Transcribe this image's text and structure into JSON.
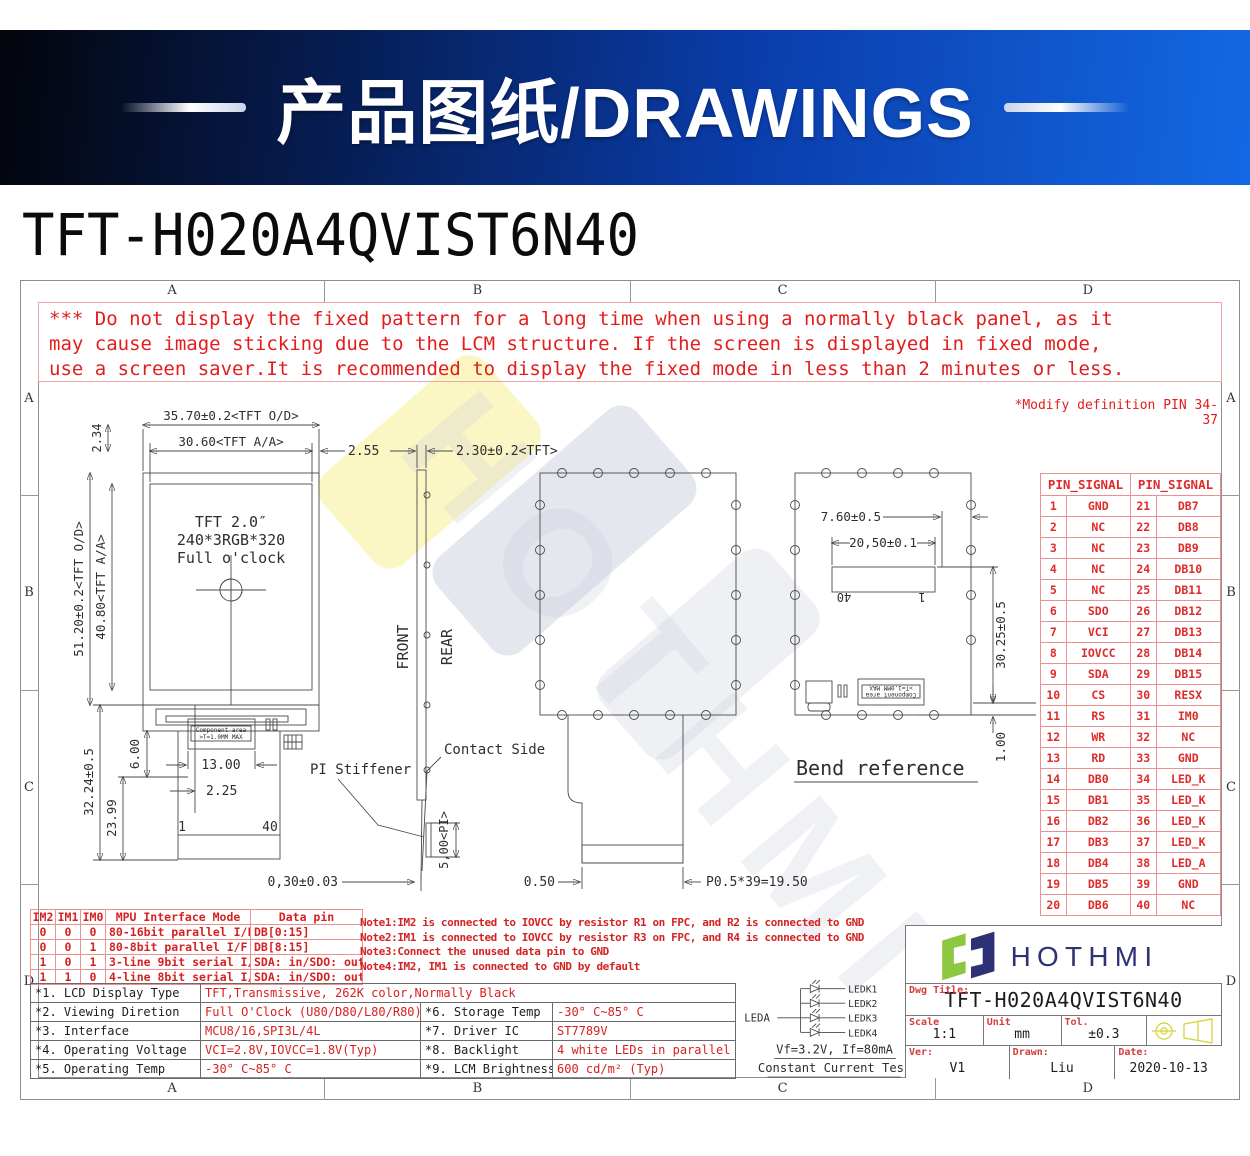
{
  "banner": {
    "title": "产品图纸/DRAWINGS"
  },
  "page_title": "TFT-H020A4QVIST6N40",
  "frame": {
    "cols": [
      "A",
      "B",
      "C",
      "D"
    ],
    "rows": [
      "A",
      "B",
      "C",
      "D"
    ]
  },
  "warning": {
    "line1": "*** Do not display the fixed pattern for a long time when using a normally black panel, as it",
    "line2": " may cause image sticking due to the LCM structure.  If the screen is displayed in fixed mode,",
    "line3": " use a screen saver.It is recommended to display the fixed mode in less than 2 minutes or less."
  },
  "modify_note": "*Modify definition PIN 34-37",
  "drawing": {
    "front": {
      "w_od": "35.70±0.2<TFT O/D>",
      "w_aa": "30.60<TFT A/A>",
      "gap": "2.55",
      "h234": "2.34",
      "h_od": "51.20±0.2<TFT O/D>",
      "h_aa": "40.80<TFT A/A>",
      "line1": "TFT 2.0″",
      "line2": "240*3RGB*320",
      "line3": "Full o'clock",
      "d3224": "32.24±0.5",
      "d2399": "23.99",
      "d600": "6.00",
      "d1300": "13.00",
      "d225": "2.25",
      "comp1": "Component area",
      "comp2": ">T=1.0MM MAX",
      "pin1": "1",
      "pin40": "40"
    },
    "side": {
      "front": "FRONT",
      "rear": "REAR",
      "thk": "2.30±0.2<TFT>",
      "pi_stiffener": "PI Stiffener",
      "pi": "5,00<PI>",
      "contact": "Contact Side",
      "tip": "0,30±0.03"
    },
    "rear": {
      "d050": "0.50",
      "pitch": "P0.5*39=19.50"
    },
    "bend": {
      "d760": "7.60±0.5",
      "d2050": "20,50±0.1",
      "d3025": "30.25±0.5",
      "d100": "1.00",
      "pin40": "40",
      "pin1": "1",
      "label": "Bend reference",
      "comp1": "Component area",
      "comp2": ">T=1.0MM MAX"
    }
  },
  "pin_table": {
    "header_left": "PIN_SIGNAL",
    "header_right": "PIN_SIGNAL",
    "rows": [
      [
        "1",
        "GND",
        "21",
        "DB7"
      ],
      [
        "2",
        "NC",
        "22",
        "DB8"
      ],
      [
        "3",
        "NC",
        "23",
        "DB9"
      ],
      [
        "4",
        "NC",
        "24",
        "DB10"
      ],
      [
        "5",
        "NC",
        "25",
        "DB11"
      ],
      [
        "6",
        "SDO",
        "26",
        "DB12"
      ],
      [
        "7",
        "VCI",
        "27",
        "DB13"
      ],
      [
        "8",
        "IOVCC",
        "28",
        "DB14"
      ],
      [
        "9",
        "SDA",
        "29",
        "DB15"
      ],
      [
        "10",
        "CS",
        "30",
        "RESX"
      ],
      [
        "11",
        "RS",
        "31",
        "IM0"
      ],
      [
        "12",
        "WR",
        "32",
        "NC"
      ],
      [
        "13",
        "RD",
        "33",
        "GND"
      ],
      [
        "14",
        "DB0",
        "34",
        "LED_K"
      ],
      [
        "15",
        "DB1",
        "35",
        "LED_K"
      ],
      [
        "16",
        "DB2",
        "36",
        "LED_K"
      ],
      [
        "17",
        "DB3",
        "37",
        "LED_K"
      ],
      [
        "18",
        "DB4",
        "38",
        "LED_A"
      ],
      [
        "19",
        "DB5",
        "39",
        "GND"
      ],
      [
        "20",
        "DB6",
        "40",
        "NC"
      ]
    ]
  },
  "mode_table": {
    "headers": [
      "IM2",
      "IM1",
      "IM0",
      "MPU Interface Mode",
      "Data pin"
    ],
    "rows": [
      [
        "0",
        "0",
        "0",
        "80-16bit parallel I/F",
        "DB[0:15]"
      ],
      [
        "0",
        "0",
        "1",
        "80-8bit parallel I/F",
        "DB[8:15]"
      ],
      [
        "1",
        "0",
        "1",
        "3-line 9bit serial I/F",
        "SDA: in/SDO: out"
      ],
      [
        "1",
        "1",
        "0",
        "4-line 8bit serial I/F",
        "SDA: in/SDO: out"
      ]
    ]
  },
  "notes": [
    "Note1:IM2 is connected to IOVCC by resistor R1 on FPC, and R2 is connected to GND",
    "Note2:IM1 is connected to IOVCC by resistor R3 on FPC, and R4 is connected to GND",
    "Note3:Connect the unused data pin to GND",
    "Note4:IM2, IM1 is connected to GND by default"
  ],
  "specs": {
    "rows": [
      [
        "*1. LCD Display Type",
        "TFT,Transmissive, 262K color,Normally Black"
      ],
      [
        "*2. Viewing Diretion",
        "Full O'Clock (U80/D80/L80/R80)"
      ],
      [
        "*3. Interface",
        "MCU8/16,SPI3L/4L"
      ],
      [
        "*4. Operating Voltage",
        "VCI=2.8V,IOVCC=1.8V(Typ)"
      ],
      [
        "*5. Operating Temp",
        "-30° C~85° C"
      ],
      [
        "*6. Storage Temp",
        "-30° C~85° C"
      ],
      [
        "*7. Driver IC",
        "ST7789V"
      ],
      [
        "*8. Backlight",
        "4 white LEDs in parallel"
      ],
      [
        "*9. LCM Brightness",
        "600 cd/m² (Typ)"
      ]
    ]
  },
  "led": {
    "anode": "LEDA",
    "cathodes": [
      "LEDK1",
      "LEDK2",
      "LEDK3",
      "LEDK4"
    ],
    "line1": "Vf=3.2V, If=80mA",
    "line2": "Constant Current Test"
  },
  "title_block": {
    "brand": "HOTHMI",
    "dwg_label": "Dwg Title:",
    "dwg_title": "TFT-H020A4QVIST6N40",
    "scale_label": "Scale",
    "scale": "1:1",
    "unit_label": "Unit",
    "unit": "mm",
    "tol_label": "Tol.",
    "tol": "±0.3",
    "ver_label": "Ver:",
    "ver": "V1",
    "drawn_label": "Drawn:",
    "drawn": "Liu",
    "date_label": "Date:",
    "date": "2020-10-13"
  }
}
